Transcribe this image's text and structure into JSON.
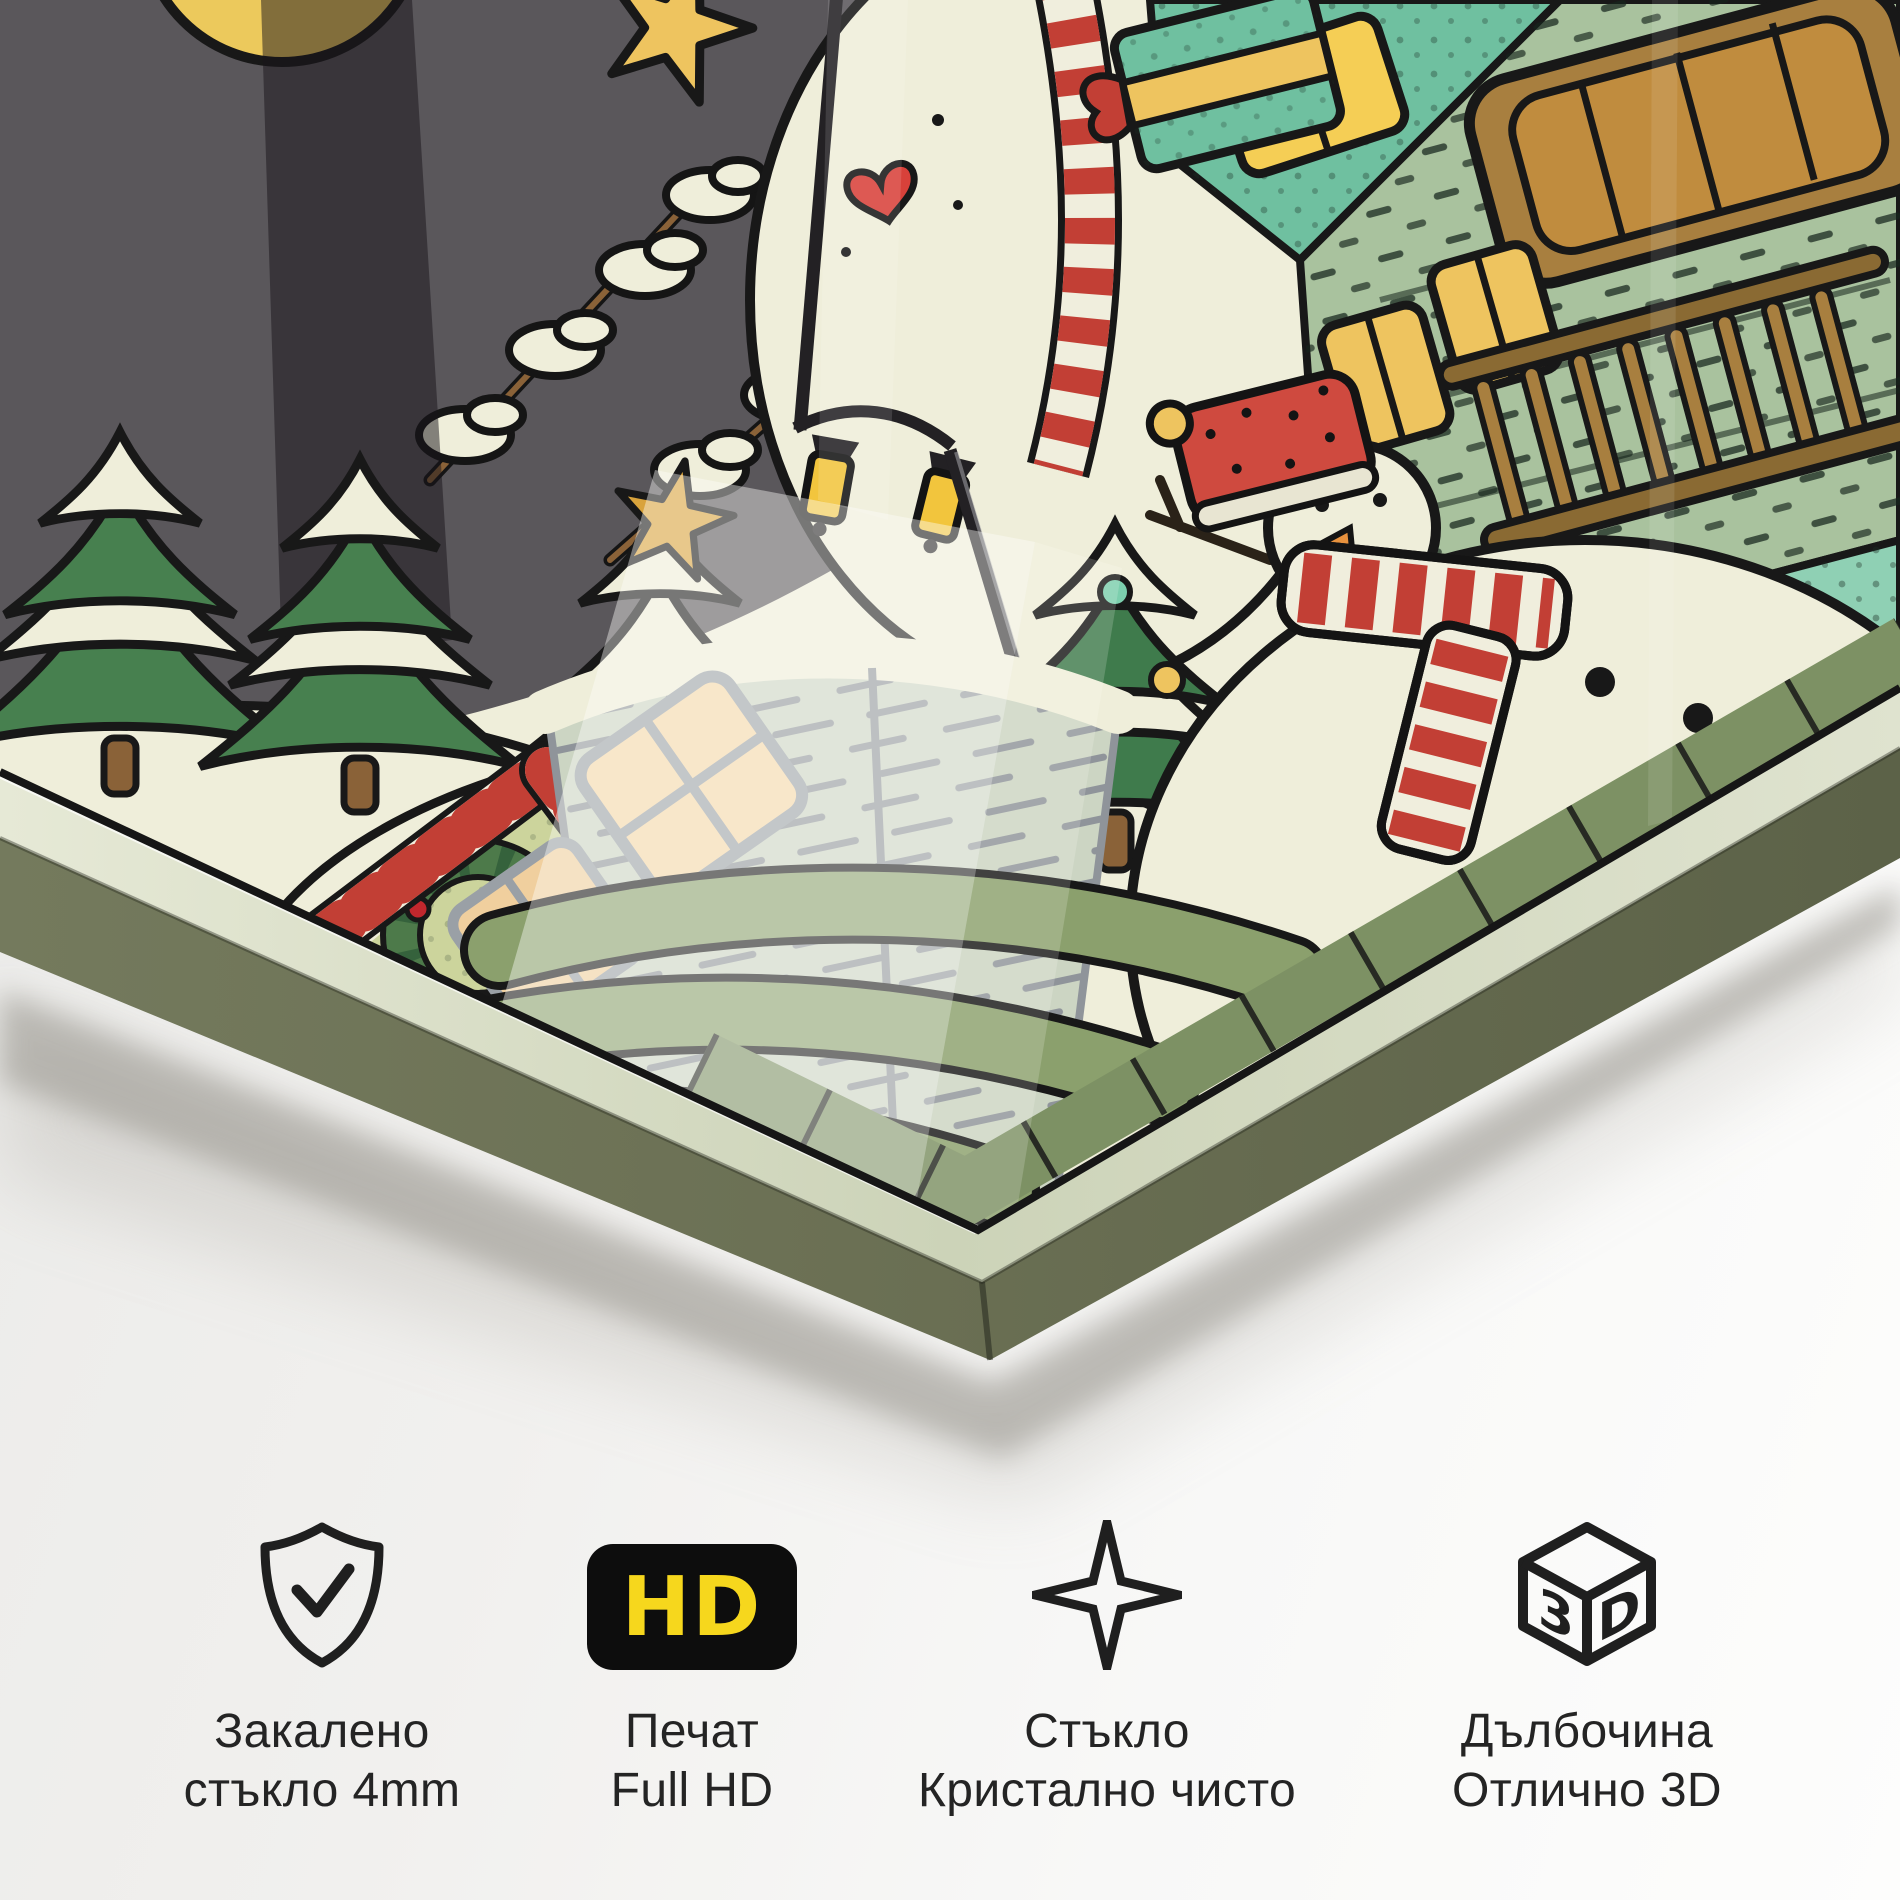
{
  "features": [
    {
      "icon": "shield-check-icon",
      "line1": "Закалено",
      "line2": "стъкло 4mm"
    },
    {
      "icon": "hd-badge-icon",
      "badge": "HD",
      "line1": "Печат",
      "line2": "Full HD"
    },
    {
      "icon": "sparkle-icon",
      "line1": "Стъкло",
      "line2": "Кристално чисто"
    },
    {
      "icon": "3d-cube-icon",
      "badge_left": "3",
      "badge_right": "D",
      "line1": "Дълбочина",
      "line2": "Отлично 3D"
    }
  ],
  "artwork": {
    "description": "Corner of a tempered-glass print, tilted, showing a hand-drawn Christmas village: night sky with moon and star, snowy firs, street lamp, snowman with red hat and striped scarf, decorated trees, teal house with wooden balcony and glowing windows, gabled house with candy-stripe trim and wreath, pale brick house; glass thickness edge and soft shadow below",
    "palette": {
      "sky": "#5a575b",
      "snow": "#efeeda",
      "outline": "#181818",
      "tree_green": "#3f7b4c",
      "fir_green": "#47804f",
      "sage": "#8ba06d",
      "sage_dark": "#7d9164",
      "red": "#c23f35",
      "dark_red": "#9e1f24",
      "berry_red": "#c1272d",
      "gold": "#eec45f",
      "amber": "#b08430",
      "teal": "#6fc0a0",
      "teal_light": "#8fd0b4",
      "pale_wall": "#a9c29e",
      "wood": "#a87f3f",
      "wood_dark": "#8a6a33",
      "pale_brick": "#ccd5c3",
      "brick_line": "#8f949a",
      "window_peach": "#f4d8a7",
      "gable_green": "#ccd49c",
      "carrot": "#e8923e",
      "hat_red": "#cf4a3f",
      "heart_red": "#d8413a",
      "lamp_black": "#232124",
      "moon": "#ecc95c",
      "glass_edge": "#6b7054",
      "glass_edge_dark": "#5c6248",
      "bevel": "#dbe0c8",
      "hd_yellow": "#f6d71d",
      "icon_black": "#0d0d0d",
      "text_color": "#242424"
    }
  }
}
